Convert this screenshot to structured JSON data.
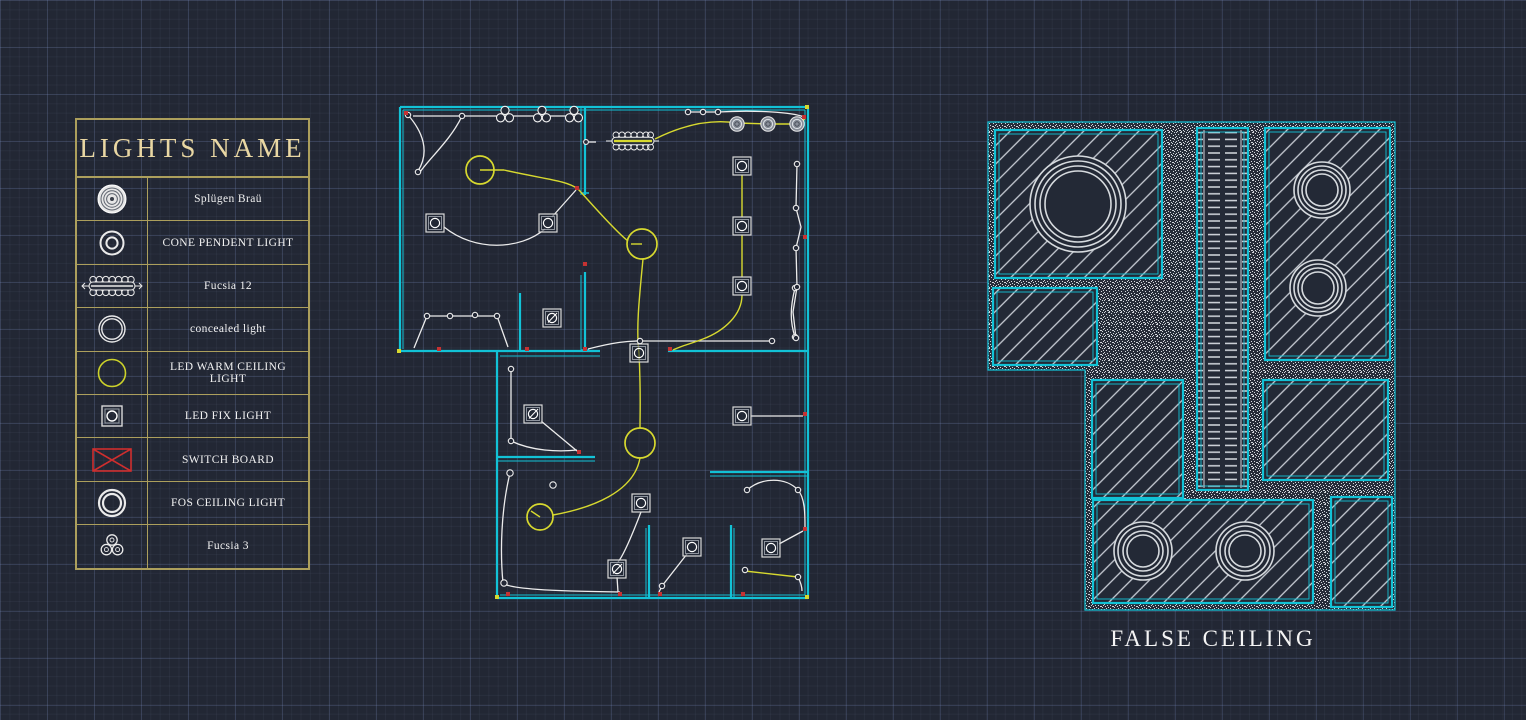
{
  "legend": {
    "title": "LIGHTS NAME",
    "rows": [
      {
        "icon": "splugen-brau-icon",
        "label": "Splügen Braü"
      },
      {
        "icon": "cone-pendent-light-icon",
        "label": "CONE PENDENT LIGHT"
      },
      {
        "icon": "fucsia-12-icon",
        "label": "Fucsia 12"
      },
      {
        "icon": "concealed-light-icon",
        "label": "concealed light"
      },
      {
        "icon": "led-warm-ceiling-light-icon",
        "label": "LED WARM CEILING LIGHT"
      },
      {
        "icon": "led-fix-light-icon",
        "label": "LED FIX LIGHT"
      },
      {
        "icon": "switch-board-icon",
        "label": "SWITCH BOARD"
      },
      {
        "icon": "fos-ceiling-light-icon",
        "label": "FOS CEILING LIGHT"
      },
      {
        "icon": "fucsia-3-icon",
        "label": "Fucsia 3"
      }
    ]
  },
  "false_ceiling": {
    "caption": "FALSE CEILING"
  },
  "colors": {
    "bg": "#222734",
    "wall": "#12c2d6",
    "wire": "#ececec",
    "wire_yellow": "#d7d92f",
    "switch_red": "#c63232",
    "legend_border": "#ac9f5c",
    "legend_title": "#e9d7a3",
    "text": "#f2f2f2",
    "hatch": "#c9ced6"
  }
}
